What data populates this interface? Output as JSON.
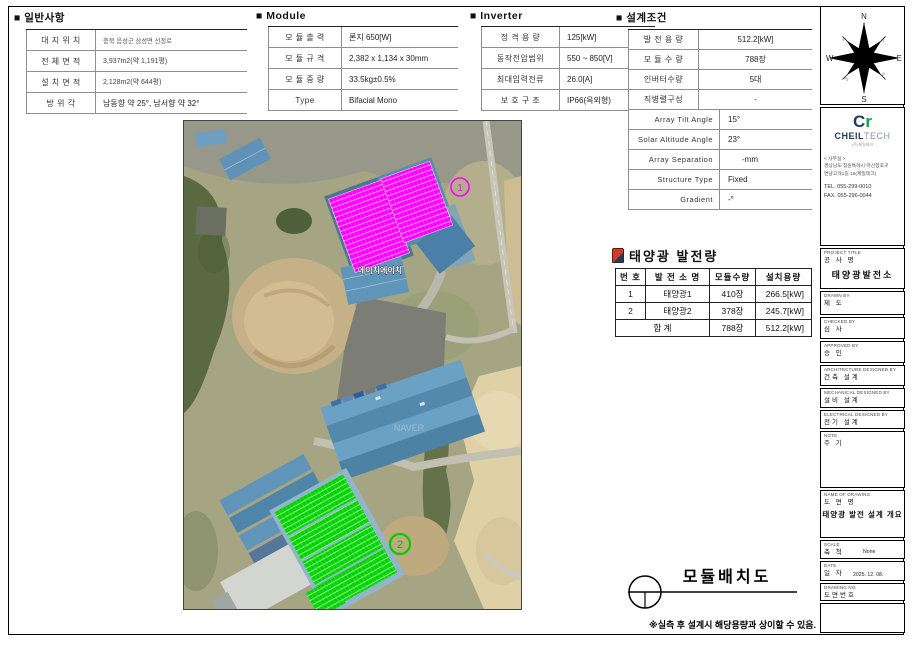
{
  "bullet": "■",
  "general": {
    "title": "일반사항",
    "rows": [
      {
        "label": "대 지 위 치",
        "value": "충북 음성군 삼성면 선정로"
      },
      {
        "label": "전 체 면 적",
        "value": "3,937m2(약 1,191평)"
      },
      {
        "label": "설 치 면 적",
        "value": "2,128m2(약 644평)"
      },
      {
        "label": "방  위  각",
        "value": "남동향 약 25°, 남서향 약 32°"
      }
    ]
  },
  "module": {
    "title": "Module",
    "rows": [
      {
        "label": "모 듈 출 력",
        "value": "론지 650[W]"
      },
      {
        "label": "모 듈 규 격",
        "value": "2,382 x 1,134 x 30mm"
      },
      {
        "label": "모 듈 중 량",
        "value": "33.5kg±0.5%"
      },
      {
        "label": "Type",
        "value": "Bifacial Mono"
      }
    ]
  },
  "inverter": {
    "title": "Inverter",
    "rows": [
      {
        "label": "정 격 용 량",
        "value": "125[kW]"
      },
      {
        "label": "동작전압범위",
        "value": "550 ~ 850[V]"
      },
      {
        "label": "최대입력전류",
        "value": "26.0[A]"
      },
      {
        "label": "보 호 구 조",
        "value": "IP66(옥외형)"
      }
    ]
  },
  "design": {
    "title": "설계조건",
    "rows": [
      {
        "label": "발 전 용 량",
        "value": "512.2[kW]"
      },
      {
        "label": "모 듈 수 량",
        "value": "788장"
      },
      {
        "label": "인버터수량",
        "value": "5대"
      },
      {
        "label": "직병렬구성",
        "value": "-"
      }
    ],
    "rows2": [
      {
        "label": "Array Tilt Angle",
        "value": "15°"
      },
      {
        "label": "Solar Altitude Angle",
        "value": "23°"
      },
      {
        "label": "Array Separation",
        "value": "-mm"
      },
      {
        "label": "Structure Type",
        "value": "Fixed"
      },
      {
        "label": "Gradient",
        "value": "-°"
      }
    ]
  },
  "generation": {
    "title": "태양광 발전량",
    "headers": [
      "번 호",
      "발 전 소 명",
      "모듈수량",
      "설치용량"
    ],
    "rows": [
      [
        "1",
        "태양광1",
        "410장",
        "266.5[kW]"
      ],
      [
        "2",
        "태양광2",
        "378장",
        "245.7[kW]"
      ]
    ],
    "total": [
      "합 계",
      "788장",
      "512.2[kW]"
    ]
  },
  "map": {
    "marker1": "1",
    "marker2": "2",
    "watermark": "에이치에이치",
    "imagery_credit": "NAVER"
  },
  "layout": {
    "title": "모듈배치도"
  },
  "footnote": "※실측 후 설계시 해당용량과 상이할 수 있음.",
  "titleblock": {
    "compass": {
      "n": "N",
      "s": "S",
      "e": "E",
      "w": "W",
      "deg": "45"
    },
    "logo": {
      "mark_c": "C",
      "mark_r": "r",
      "name_bold": "CHEIL",
      "name_light": "TECH",
      "sub": "(주)제일테크"
    },
    "office": {
      "heading": "< 사무실 >",
      "addr1": "경상남도 창원특례시 마산합포구",
      "addr2": "연남고개1길 16(제일테크)",
      "tel": "TEL. 055-299-0010",
      "fax": "FAX. 055-296-0044"
    },
    "fields": [
      {
        "en": "PROJECT TITLE",
        "ko": "공 사 명",
        "value": "태양광발전소"
      },
      {
        "en": "DRAWN BY",
        "ko": "제 도",
        "value": ""
      },
      {
        "en": "CHECKED BY",
        "ko": "심 사",
        "value": ""
      },
      {
        "en": "APPROVED BY",
        "ko": "승 인",
        "value": ""
      },
      {
        "en": "ARCHITECTURE DESIGNED BY",
        "ko": "건축 설계",
        "value": ""
      },
      {
        "en": "MECHANICAL DESIGNED BY",
        "ko": "설비 설계",
        "value": ""
      },
      {
        "en": "ELECTRICAL DESIGNED BY",
        "ko": "전기 설계",
        "value": ""
      },
      {
        "en": "NOTE",
        "ko": "주 기",
        "value": ""
      },
      {
        "en": "NAME OF DRAWING",
        "ko": "도 면 명",
        "value": "태양광 발전 설계 개요"
      },
      {
        "en": "SCALE",
        "ko": "축 척",
        "value": "None"
      },
      {
        "en": "DATE",
        "ko": "일 자",
        "value": "2025. 12. 08."
      },
      {
        "en": "DRAWING NO",
        "ko": "도면번호",
        "value": ""
      }
    ]
  },
  "colors": {
    "panel_magenta": "#ff00ff",
    "panel_green": "#00d400",
    "logo_navy": "#1d3a5f",
    "logo_green": "#00a651"
  }
}
